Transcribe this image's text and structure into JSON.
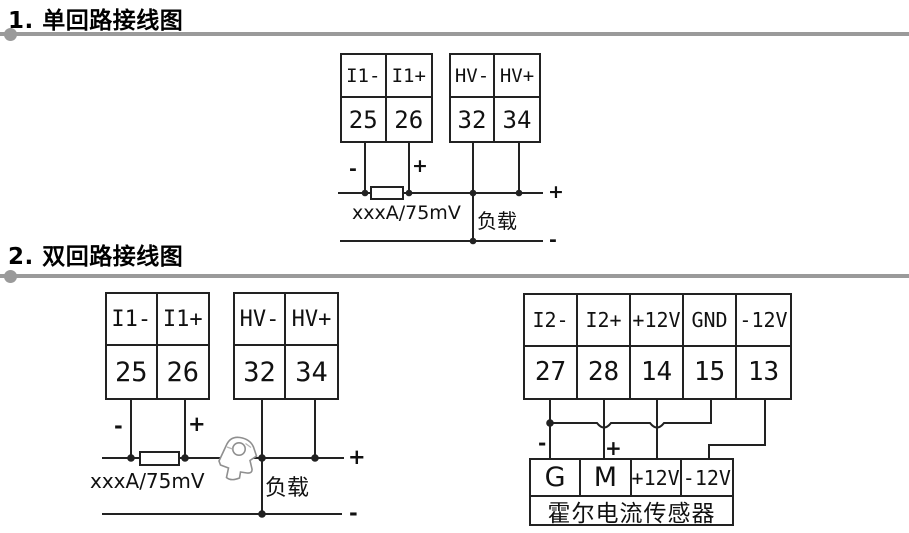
{
  "colors": {
    "line": "#222222",
    "divider": "#9a9a9a",
    "text": "#111111"
  },
  "section1": {
    "title": "1. 单回路接线图",
    "blockA": {
      "top": [
        "I1-",
        "I1+"
      ],
      "bottom": [
        "25",
        "26"
      ]
    },
    "blockB": {
      "top": [
        "HV-",
        "HV+"
      ],
      "bottom": [
        "32",
        "34"
      ]
    },
    "labels": {
      "shunt_minus": "-",
      "shunt_plus": "+",
      "shunt": "xxxA/75mV",
      "load": "负载",
      "out_plus": "+",
      "out_minus": "-"
    }
  },
  "section2": {
    "title": "2. 双回路接线图",
    "left": {
      "blockA": {
        "top": [
          "I1-",
          "I1+"
        ],
        "bottom": [
          "25",
          "26"
        ]
      },
      "blockB": {
        "top": [
          "HV-",
          "HV+"
        ],
        "bottom": [
          "32",
          "34"
        ]
      },
      "labels": {
        "shunt_minus": "-",
        "shunt_plus": "+",
        "shunt": "xxxA/75mV",
        "load": "负载",
        "out_plus": "+",
        "out_minus": "-"
      }
    },
    "right": {
      "block": {
        "top": [
          "I2-",
          "I2+",
          "+12V",
          "GND",
          "-12V"
        ],
        "bottom": [
          "27",
          "28",
          "14",
          "15",
          "13"
        ]
      },
      "labels": {
        "minus": "-",
        "plus": "+"
      },
      "sensor": {
        "terminals": [
          "G",
          "M",
          "+12V",
          "-12V"
        ],
        "name": "霍尔电流传感器"
      }
    }
  }
}
